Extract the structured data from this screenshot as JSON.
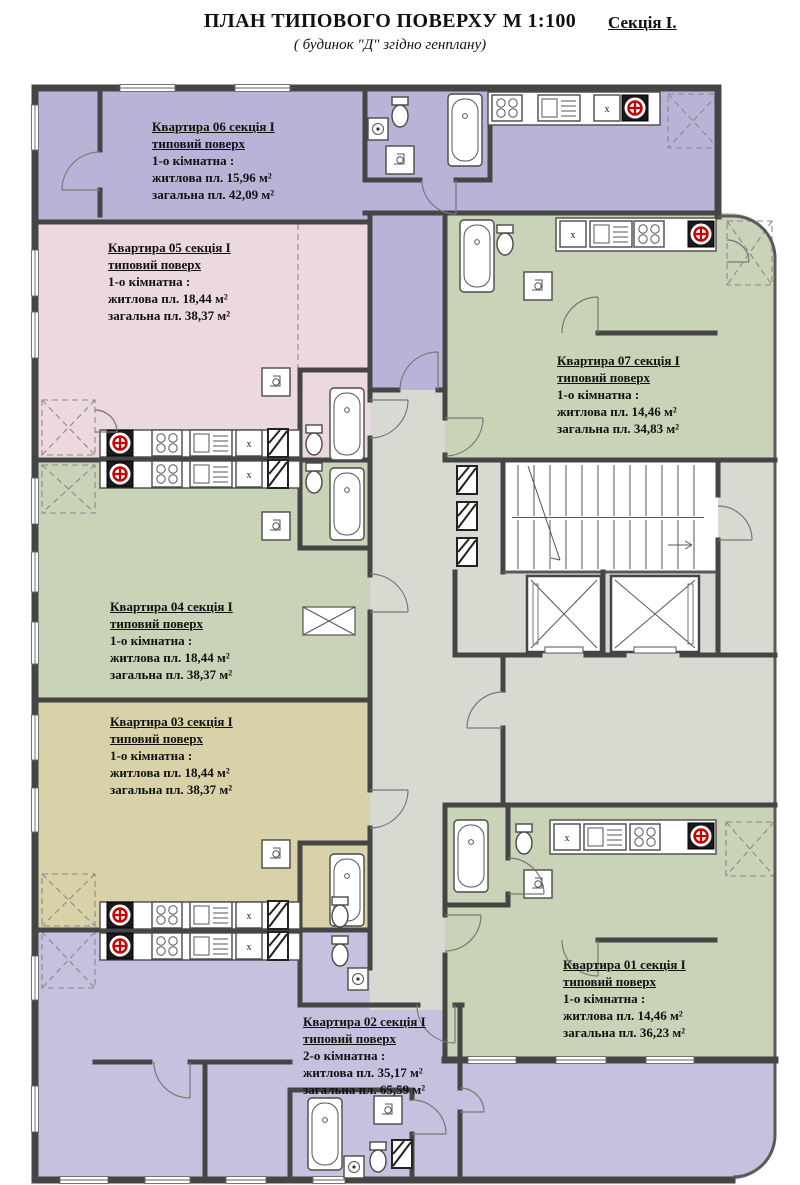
{
  "title": {
    "main": "ПЛАН ТИПОВОГО ПОВЕРХУ  М 1:100",
    "section": "Секція I.",
    "subtitle": "( будинок  \"Д\" згідно генплану)"
  },
  "symbols": {
    "shaft_label": "х"
  },
  "colors": {
    "walls": "#454545",
    "apt06_lavender": "#b9b4d7",
    "apt02_lavender": "#c6c1df",
    "apt05_pink": "#ecd9de",
    "green": "#c8d3b8",
    "apt03_tan": "#d9d2a8",
    "corridor_gray": "#d8d9d0",
    "stove_red": "#cc0000"
  },
  "apartments": [
    {
      "num": "01",
      "l1": "Квартира 01 секція I",
      "l2": "типовий поверх",
      "l3": "1-о кімнатна :",
      "l4": "житлова пл. 14,46 м²",
      "l5": "загальна пл. 36,23 м²"
    },
    {
      "num": "02",
      "l1": "Квартира 02 секція I",
      "l2": "типовий поверх",
      "l3": "2-о кімнатна :",
      "l4": "житлова пл. 35,17 м²",
      "l5": "загальна пл. 65,59 м²"
    },
    {
      "num": "03",
      "l1": "Квартира 03 секція I",
      "l2": "типовий поверх",
      "l3": "1-о кімнатна :",
      "l4": "житлова пл. 18,44 м²",
      "l5": "загальна пл. 38,37 м²"
    },
    {
      "num": "04",
      "l1": "Квартира 04 секція I",
      "l2": "типовий поверх",
      "l3": "1-о кімнатна :",
      "l4": "житлова пл. 18,44 м²",
      "l5": "загальна пл. 38,37 м²"
    },
    {
      "num": "05",
      "l1": "Квартира 05 секція I",
      "l2": "типовий поверх",
      "l3": "1-о кімнатна :",
      "l4": "житлова пл. 18,44 м²",
      "l5": "загальна пл. 38,37 м²"
    },
    {
      "num": "06",
      "l1": "Квартира 06 секція I",
      "l2": "типовий поверх",
      "l3": "1-о кімнатна :",
      "l4": "житлова пл. 15,96 м²",
      "l5": "загальна пл. 42,09 м²"
    },
    {
      "num": "07",
      "l1": "Квартира 07 секція I",
      "l2": "типовий поверх",
      "l3": "1-о кімнатна :",
      "l4": "житлова пл. 14,46 м²",
      "l5": "загальна пл. 34,83 м²"
    }
  ]
}
